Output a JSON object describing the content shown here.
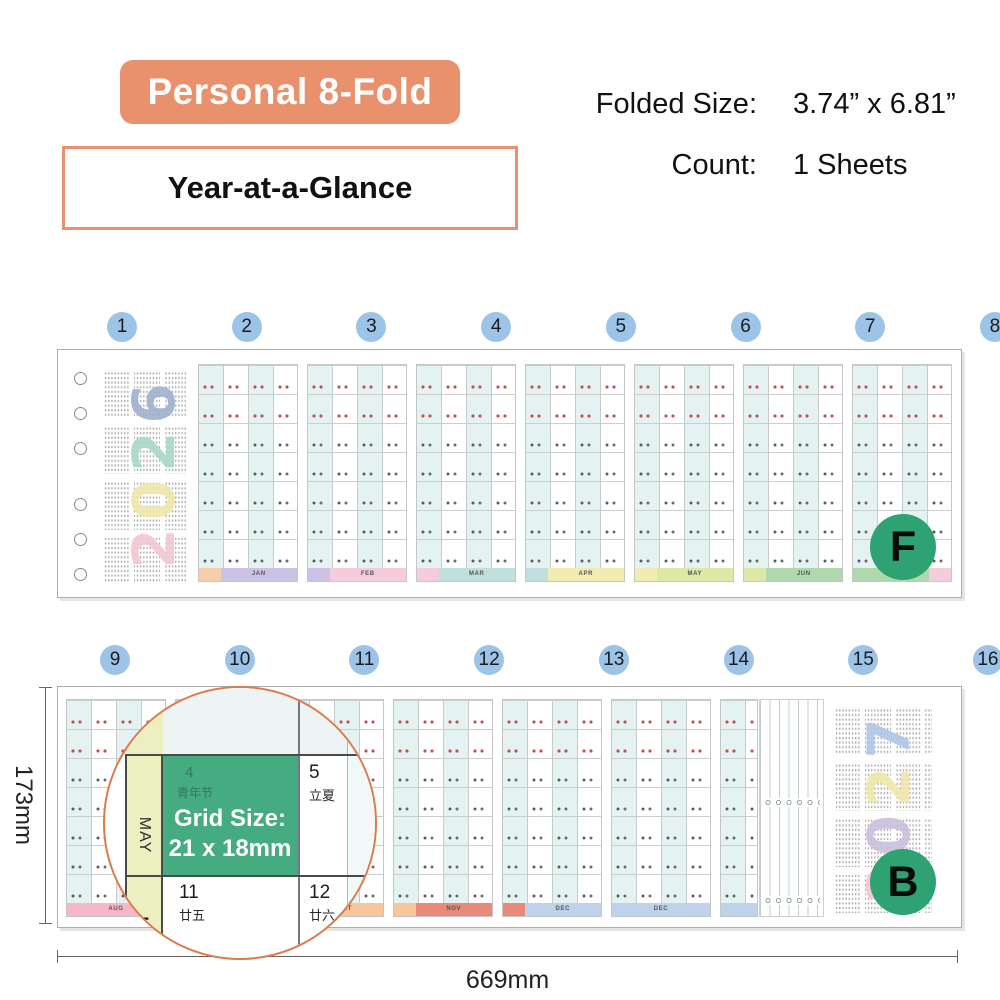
{
  "header": {
    "title_badge": "Personal 8-Fold",
    "subtitle": "Year-at-a-Glance",
    "specs": [
      {
        "label": "Folded Size:",
        "value": "3.74” x 6.81”"
      },
      {
        "label": "Count:",
        "value": "1 Sheets"
      }
    ]
  },
  "front_strip": {
    "panel_numbers": [
      "1",
      "2",
      "3",
      "4",
      "5",
      "6",
      "7",
      "8"
    ],
    "side_badge": "F",
    "cover_year": {
      "text": "2026",
      "digits": [
        {
          "char": "2",
          "color": "#F3C7D2"
        },
        {
          "char": "0",
          "color": "#EFE8A9"
        },
        {
          "char": "2",
          "color": "#A9D8C6"
        },
        {
          "char": "6",
          "color": "#9FB1CE"
        }
      ]
    },
    "month_panels": [
      {
        "footer": [
          {
            "color": "#F6CFA8",
            "label": "",
            "w": 22
          },
          {
            "color": "#CCC2E5",
            "label": "JAN",
            "w": 78
          }
        ]
      },
      {
        "footer": [
          {
            "color": "#CCC2E5",
            "label": "",
            "w": 22
          },
          {
            "color": "#F6CBDB",
            "label": "FEB",
            "w": 78
          }
        ]
      },
      {
        "footer": [
          {
            "color": "#F6CBDB",
            "label": "",
            "w": 22
          },
          {
            "color": "#BFE0DC",
            "label": "MAR",
            "w": 78
          }
        ]
      },
      {
        "footer": [
          {
            "color": "#BFE0DC",
            "label": "",
            "w": 22
          },
          {
            "color": "#F1ECB2",
            "label": "APR",
            "w": 78
          }
        ]
      },
      {
        "footer": [
          {
            "color": "#F1ECB2",
            "label": "",
            "w": 22
          },
          {
            "color": "#DDE7A6",
            "label": "MAY",
            "w": 78
          }
        ]
      },
      {
        "footer": [
          {
            "color": "#DDE7A6",
            "label": "",
            "w": 22
          },
          {
            "color": "#AFD8AC",
            "label": "JUN",
            "w": 78
          }
        ]
      },
      {
        "footer": [
          {
            "color": "#AFD8AC",
            "label": "JUL",
            "w": 78
          },
          {
            "color": "#F6CBDB",
            "label": "",
            "w": 22
          }
        ]
      }
    ]
  },
  "back_strip": {
    "panel_numbers": [
      "9",
      "10",
      "11",
      "12",
      "13",
      "14",
      "15",
      "16"
    ],
    "side_badge": "B",
    "cover_year": {
      "text": "2027",
      "digits": [
        {
          "char": "2",
          "color": "#F3C7D2"
        },
        {
          "char": "0",
          "color": "#C9C0DE"
        },
        {
          "char": "2",
          "color": "#EFE8A9"
        },
        {
          "char": "7",
          "color": "#AFC6E8"
        }
      ]
    },
    "month_panels": [
      {
        "footer": [
          {
            "color": "#F6B8C8",
            "label": "AUG",
            "w": 100
          }
        ]
      },
      {
        "footer": [
          {
            "color": "#F6B8C8",
            "label": "",
            "w": 22
          },
          {
            "color": "#F5E9A0",
            "label": "SEP",
            "w": 78
          }
        ]
      },
      {
        "footer": [
          {
            "color": "#F5E9A0",
            "label": "",
            "w": 22
          },
          {
            "color": "#F5C79B",
            "label": "OCT",
            "w": 78
          }
        ]
      },
      {
        "footer": [
          {
            "color": "#F5C79B",
            "label": "",
            "w": 22
          },
          {
            "color": "#E8897A",
            "label": "NOV",
            "w": 78
          }
        ]
      },
      {
        "footer": [
          {
            "color": "#E8897A",
            "label": "",
            "w": 22
          },
          {
            "color": "#BFD2EC",
            "label": "DEC",
            "w": 78
          }
        ]
      },
      {
        "footer": [
          {
            "color": "#BFD2EC",
            "label": "DEC",
            "w": 100
          }
        ]
      },
      {
        "narrow": true,
        "footer": [
          {
            "color": "#BFD2EC",
            "label": "",
            "w": 100
          }
        ]
      }
    ]
  },
  "magnifier": {
    "grid_size_label": "Grid Size:",
    "grid_size_value": "21 x 18mm",
    "month_label": "MAY",
    "month_number": "5",
    "cells": [
      {
        "day": "4",
        "note": "青年节",
        "highlight": true
      },
      {
        "day": "5",
        "note": "立夏",
        "highlight": false
      },
      {
        "day": "11",
        "note": "廿五",
        "highlight": false
      },
      {
        "day": "12",
        "note": "廿六",
        "highlight": false
      }
    ]
  },
  "dimensions": {
    "height_label": "173mm",
    "width_label": "669mm"
  },
  "colors": {
    "accent_orange": "#E8916C",
    "number_circle_blue": "#9CC4E8",
    "side_badge_green": "#2EA273",
    "magnifier_green": "#45AB80",
    "magnifier_ring": "#DC7B4A"
  }
}
